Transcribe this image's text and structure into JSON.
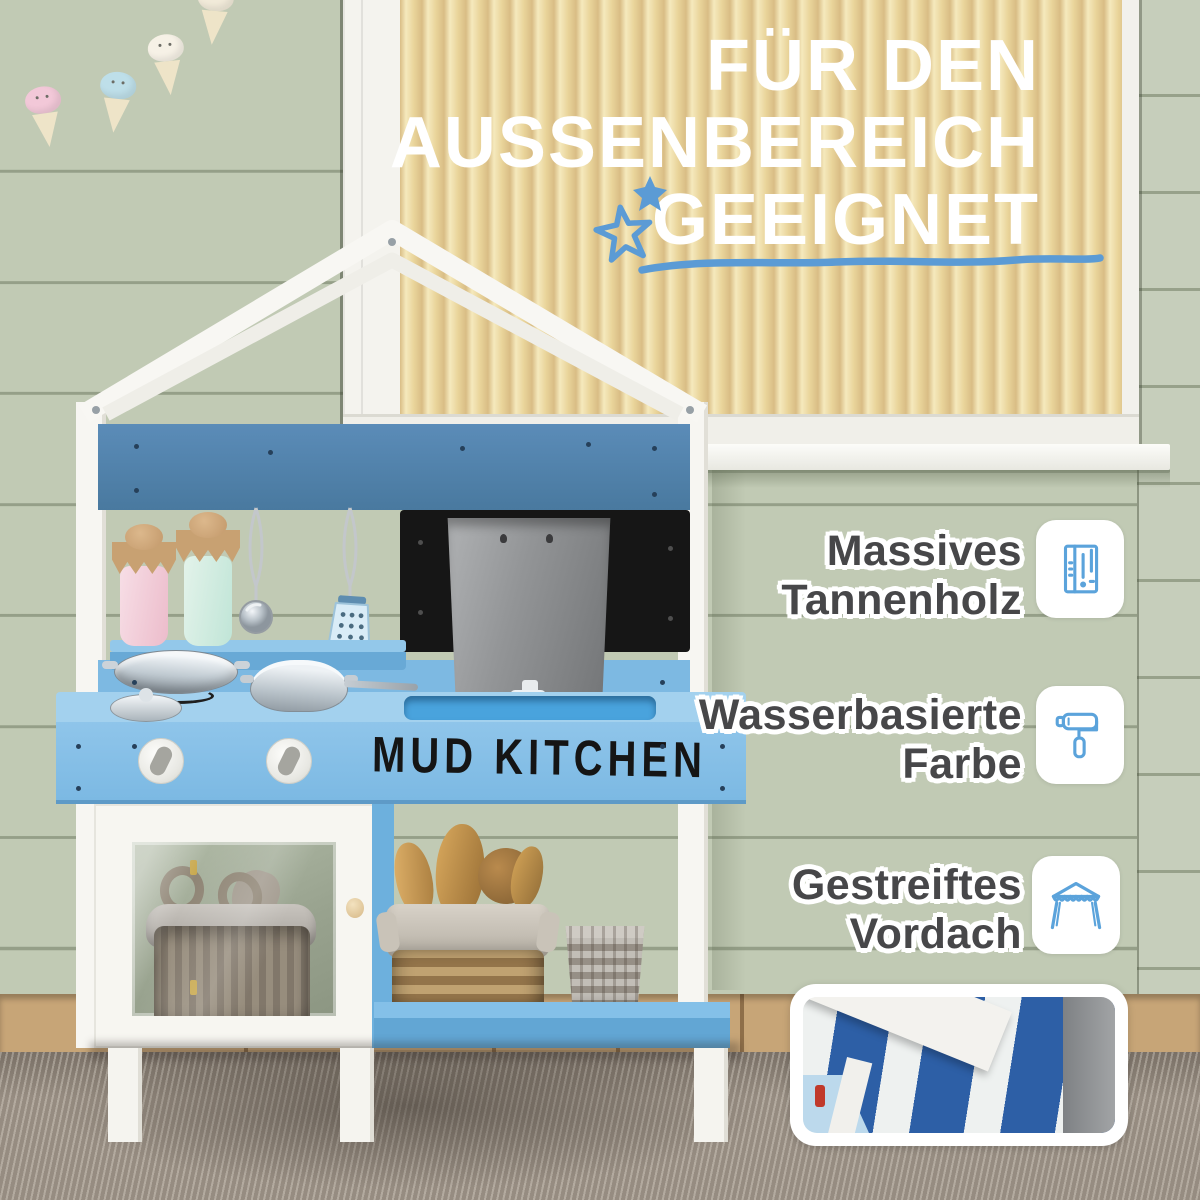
{
  "headline": {
    "lines": [
      "FÜR DEN",
      "AUSSENBEREICH",
      "GEEIGNET"
    ]
  },
  "product": {
    "label": "MUD KITCHEN"
  },
  "features": [
    {
      "line1": "Massives",
      "line2": "Tannenholz",
      "icon": "wood-planks-icon"
    },
    {
      "line1": "Wasserbasierte",
      "line2": "Farbe",
      "icon": "paint-roller-icon"
    },
    {
      "line1": "Gestreiftes",
      "line2": "Vordach",
      "icon": "canopy-icon"
    }
  ],
  "decorations": {
    "doodles": [
      "filled-star-icon",
      "outline-star-icon",
      "hand-drawn-underline"
    ],
    "garland_scoop_colors": [
      "pink",
      "blue",
      "white",
      "cream"
    ]
  },
  "colors": {
    "accent_blue": "#5b9bd5",
    "icon_stroke_blue": "#5ba3db",
    "kitchen_dark_blue": "#4d81ad",
    "kitchen_light_blue": "#7db9e2",
    "canopy_stripe_blue": "#2d5fa6",
    "wall_green": "#c1cab4",
    "blinds_yellow": "#e9d49a",
    "headline_white": "#ffffff",
    "feature_text": "#474749"
  }
}
